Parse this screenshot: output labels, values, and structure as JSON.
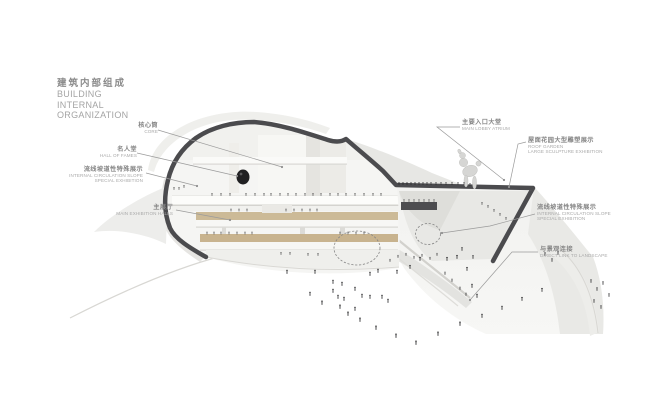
{
  "title": {
    "zh": "建筑内部组成",
    "en_lines": [
      "BUILDING",
      "INTERNAL",
      "ORGANIZATION"
    ]
  },
  "labels": {
    "left": [
      {
        "id": "core",
        "zh": "核心筒",
        "en_lines": [
          "CORE"
        ]
      },
      {
        "id": "hall-of-fames",
        "zh": "名人堂",
        "en_lines": [
          "HALL OF FAMES"
        ]
      },
      {
        "id": "circulation-left",
        "zh": "流线坡道性特殊展示",
        "en_lines": [
          "INTERNAL CIRCULATION SLOPE",
          "SPECIAL EXHIBITION"
        ]
      },
      {
        "id": "main-exhibition",
        "zh": "主展厅",
        "en_lines": [
          "MAIN EXHIBITION HALLS"
        ]
      }
    ],
    "right": [
      {
        "id": "main-lobby",
        "zh": "主要入口大堂",
        "en_lines": [
          "MAIN LOBBY ATRIUM"
        ]
      },
      {
        "id": "roof-garden",
        "zh": "屋面花园大型雕塑展示",
        "en_lines": [
          "ROOF GARDEN",
          "LARGE SCULPTURE EXHIBITION"
        ]
      },
      {
        "id": "circulation-right",
        "zh": "流线坡道性特殊展示",
        "en_lines": [
          "INTERNAL CIRCULATION SLOPE",
          "SPECIAL EXHIBITION"
        ]
      },
      {
        "id": "landscape-link",
        "zh": "与景观连接",
        "en_lines": [
          "DIRECT LINK TO LANDSCAPE"
        ]
      }
    ]
  },
  "colors": {
    "background": "#ffffff",
    "section_outline": "#4b4b4e",
    "floor_wood": "#cbb996",
    "label_zh": "#858585",
    "label_en": "#a9a9a9",
    "leader_line": "#9b9b9b",
    "people": "#1b1b1d"
  }
}
